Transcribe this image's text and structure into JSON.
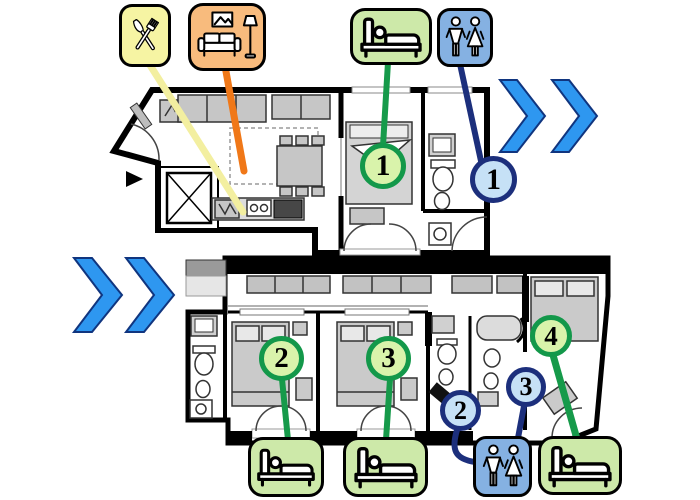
{
  "diagram": {
    "description": "apartment floor plans, two levels, connected by next-step chevrons",
    "colors": {
      "kitchen_tile": "#f6f4a3",
      "living_room_tile": "#f8bb7d",
      "bedroom_tile": "#cde9a9",
      "bathroom_tile": "#85b1e2",
      "kitchen_line": "#f3efa0",
      "living_room_line": "#f07818",
      "bedroom_line": "#169a4a",
      "bathroom_line": "#1c2f7c",
      "bedroom_badge_fill": "#d9f3ab",
      "bedroom_badge_border": "#13984a",
      "bathroom_badge_fill": "#c6e1f6",
      "bathroom_badge_border": "#1c2f7c",
      "chevron": "#2e97f0"
    },
    "icons": {
      "top_row": [
        "kitchen-icon",
        "living-room-icon",
        "bedroom-icon",
        "bathroom-icon"
      ],
      "bottom_row": [
        "bedroom-icon",
        "bedroom-icon",
        "bathroom-icon",
        "bedroom-icon"
      ]
    }
  },
  "markers": {
    "bedrooms": [
      {
        "number": "1"
      },
      {
        "number": "2"
      },
      {
        "number": "3"
      },
      {
        "number": "4"
      }
    ],
    "bathrooms": [
      {
        "number": "1"
      },
      {
        "number": "2"
      },
      {
        "number": "3"
      }
    ]
  }
}
